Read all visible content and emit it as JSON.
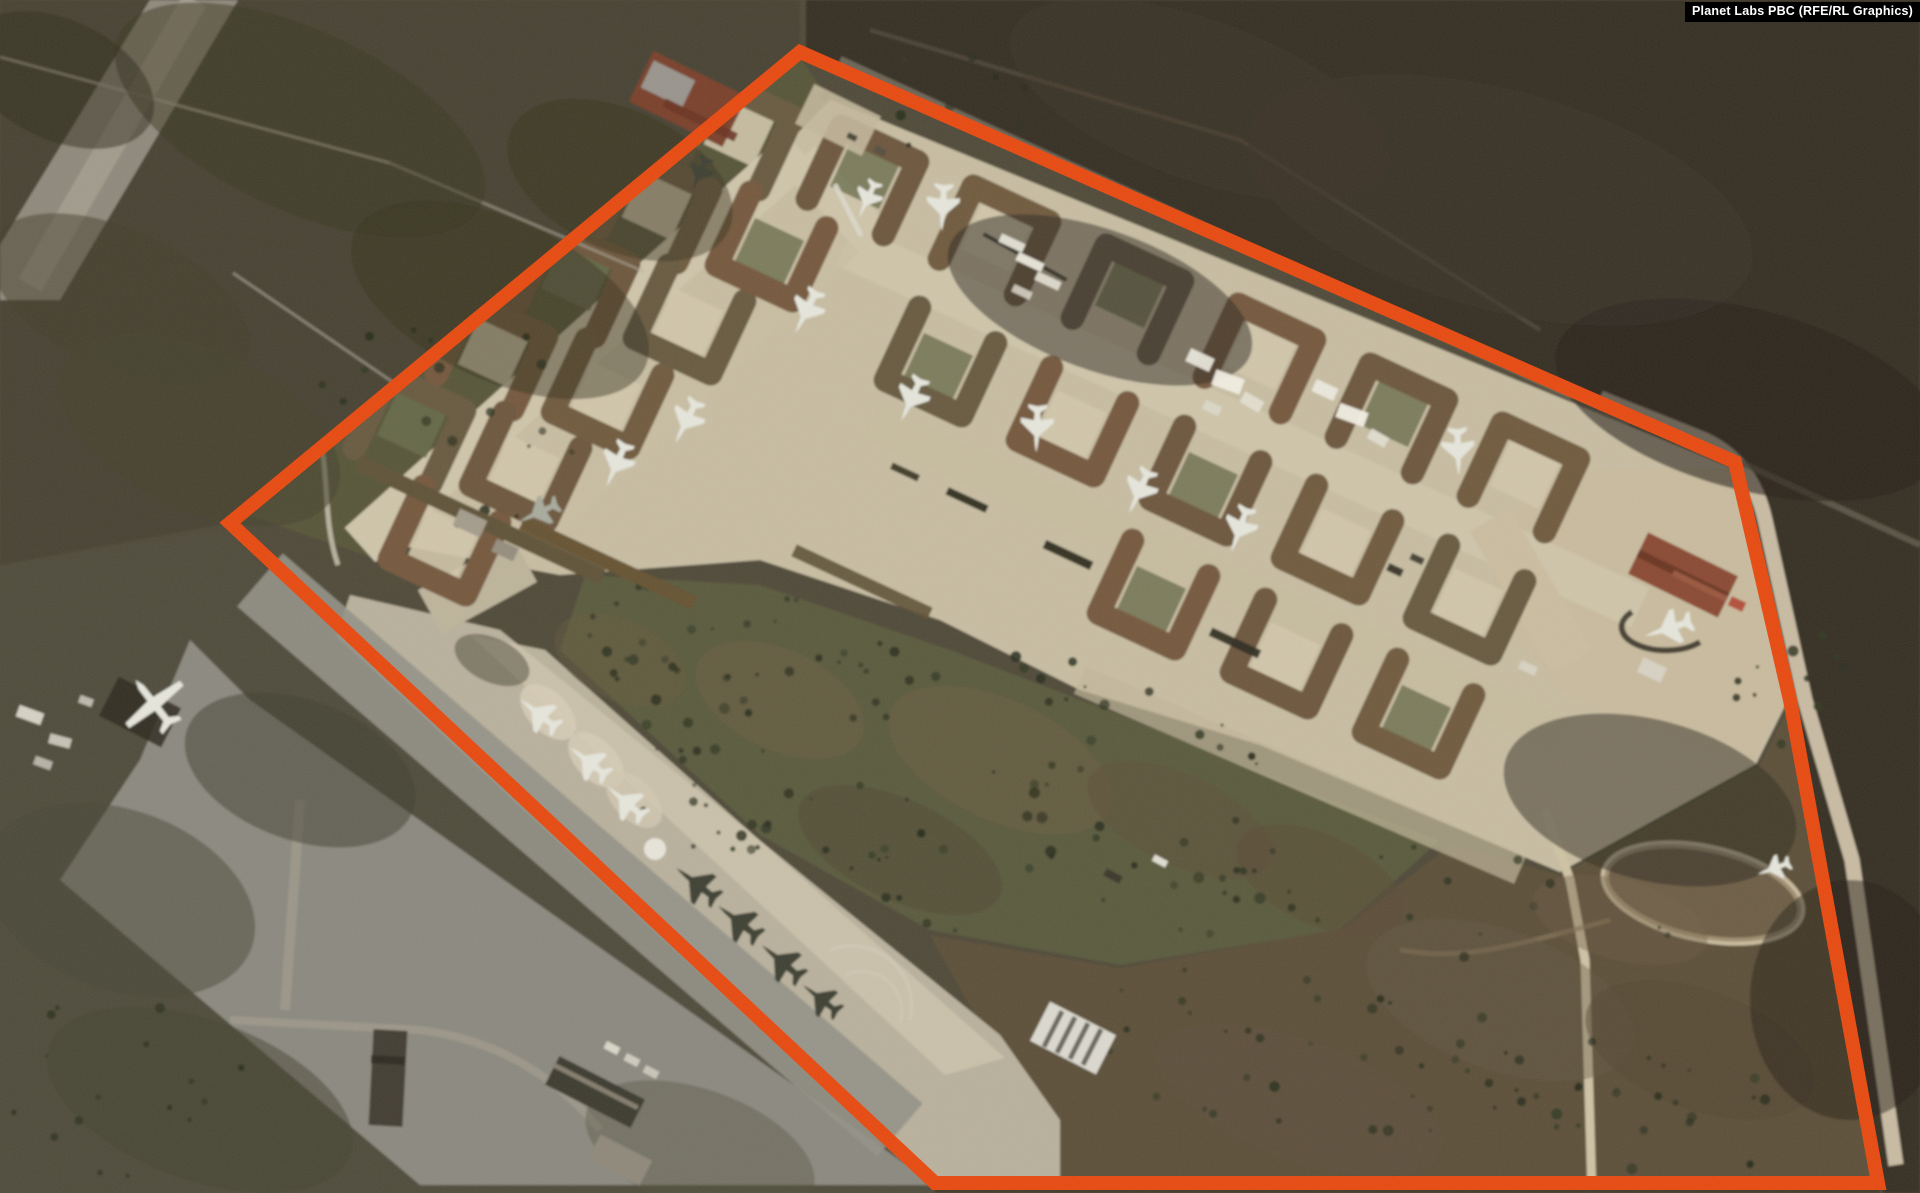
{
  "watermark": {
    "text": "Planet Labs PBC (RFE/RL Graphics)",
    "bg": "#000000",
    "color": "#ffffff"
  },
  "annotation": {
    "label": "highlighted-airbase-area",
    "color": "#E8490F",
    "stroke_width": 14,
    "points": "800,52 1735,462 1790,700 1878,1183 935,1183 230,523"
  },
  "scene": {
    "palette": {
      "field_dark": "#352e24",
      "field_olive": "#4f4a38",
      "grass": "#5a5a3d",
      "apron": "#b9b19c",
      "revetment_pad_tan": "#d2c7ab",
      "revetment_pad_green": "#696b4b",
      "berm": "#6d563c",
      "pavement": "#8b897f",
      "tree": "#2b301f",
      "jet_light": "#e6e6dc",
      "jet_dark": "#3d4033"
    },
    "aircraft": [
      {
        "k": "jet",
        "x": 943,
        "y": 206,
        "r": 183,
        "s": 1.1,
        "t": "light"
      },
      {
        "k": "jet",
        "x": 868,
        "y": 198,
        "r": 205,
        "s": 0.9,
        "t": "light"
      },
      {
        "k": "jet",
        "x": 807,
        "y": 310,
        "r": 207,
        "s": 1.1,
        "t": "light"
      },
      {
        "k": "jet",
        "x": 687,
        "y": 420,
        "r": 207,
        "s": 1.1,
        "t": "light"
      },
      {
        "k": "jet",
        "x": 617,
        "y": 463,
        "r": 204,
        "s": 1.1,
        "t": "light"
      },
      {
        "k": "jet",
        "x": 700,
        "y": 173,
        "r": 205,
        "s": 0.85,
        "t": "dark"
      },
      {
        "k": "jet",
        "x": 540,
        "y": 512,
        "r": 245,
        "s": 1.0,
        "t": "mid"
      },
      {
        "k": "jet",
        "x": 912,
        "y": 398,
        "r": 205,
        "s": 1.1,
        "t": "light"
      },
      {
        "k": "jet",
        "x": 1037,
        "y": 427,
        "r": 182,
        "s": 1.1,
        "t": "light"
      },
      {
        "k": "jet",
        "x": 1140,
        "y": 490,
        "r": 205,
        "s": 1.1,
        "t": "light"
      },
      {
        "k": "jet",
        "x": 1240,
        "y": 528,
        "r": 200,
        "s": 1.1,
        "t": "light"
      },
      {
        "k": "jet",
        "x": 1458,
        "y": 450,
        "r": 178,
        "s": 1.1,
        "t": "light"
      },
      {
        "k": "jet",
        "x": 1670,
        "y": 628,
        "r": 252,
        "s": 1.15,
        "t": "light"
      },
      {
        "k": "jet",
        "x": 1775,
        "y": 868,
        "r": 250,
        "s": 0.8,
        "t": "light"
      },
      {
        "k": "jet",
        "x": 540,
        "y": 715,
        "r": -52,
        "s": 1.1,
        "t": "light"
      },
      {
        "k": "jet",
        "x": 590,
        "y": 763,
        "r": -52,
        "s": 1.1,
        "t": "light"
      },
      {
        "k": "jet",
        "x": 627,
        "y": 803,
        "r": -50,
        "s": 1.1,
        "t": "light"
      },
      {
        "k": "jet",
        "x": 698,
        "y": 885,
        "r": -52,
        "s": 1.2,
        "t": "dark"
      },
      {
        "k": "jet",
        "x": 740,
        "y": 923,
        "r": -52,
        "s": 1.2,
        "t": "dark"
      },
      {
        "k": "jet",
        "x": 783,
        "y": 963,
        "r": -50,
        "s": 1.2,
        "t": "dark"
      },
      {
        "k": "jet",
        "x": 822,
        "y": 1000,
        "r": -52,
        "s": 1.05,
        "t": "dark"
      },
      {
        "k": "prop",
        "x": 155,
        "y": 705,
        "r": -38,
        "s": 1.5,
        "t": "light"
      }
    ],
    "revetments": [
      [
        865,
        175,
        25
      ],
      [
        997,
        235,
        25
      ],
      [
        1130,
        294,
        25
      ],
      [
        1262,
        353,
        25
      ],
      [
        1394,
        413,
        25
      ],
      [
        1526,
        472,
        25
      ],
      [
        938,
        367,
        205
      ],
      [
        1070,
        427,
        205
      ],
      [
        1203,
        486,
        205
      ],
      [
        1335,
        545,
        205
      ],
      [
        1467,
        605,
        205
      ],
      [
        1151,
        600,
        205
      ],
      [
        1284,
        659,
        205
      ],
      [
        1416,
        719,
        205
      ],
      [
        412,
        424,
        25
      ],
      [
        494,
        350,
        25
      ],
      [
        576,
        277,
        25
      ],
      [
        658,
        203,
        25
      ],
      [
        740,
        130,
        25
      ],
      [
        442,
        546,
        205
      ],
      [
        523,
        472,
        205
      ],
      [
        605,
        399,
        205
      ],
      [
        687,
        325,
        205
      ],
      [
        769,
        252,
        205
      ]
    ],
    "pads_green": [
      [
        865,
        175
      ],
      [
        1130,
        294
      ],
      [
        1394,
        413
      ],
      [
        938,
        367
      ],
      [
        1203,
        486
      ],
      [
        412,
        424
      ],
      [
        576,
        277
      ],
      [
        769,
        252
      ],
      [
        1151,
        600
      ],
      [
        1416,
        719
      ]
    ],
    "pads_tan": [
      [
        997,
        235
      ],
      [
        1262,
        353
      ],
      [
        1526,
        472
      ],
      [
        1070,
        427
      ],
      [
        1335,
        545
      ],
      [
        523,
        472
      ],
      [
        687,
        325
      ],
      [
        1284,
        659
      ],
      [
        494,
        350
      ],
      [
        658,
        203
      ],
      [
        740,
        130
      ],
      [
        605,
        399
      ],
      [
        442,
        546
      ],
      [
        1467,
        605
      ]
    ],
    "buildings": [
      [
        688,
        99,
        104,
        56,
        26,
        "#7a3f2c",
        1
      ],
      [
        668,
        84,
        46,
        30,
        26,
        "#99948c",
        1
      ],
      [
        700,
        120,
        80,
        9,
        26,
        "#6a3424",
        0.9
      ],
      [
        1683,
        575,
        100,
        46,
        26,
        "#8a4a33",
        1
      ],
      [
        1683,
        575,
        100,
        8,
        26,
        "#67331f",
        0.9
      ],
      [
        1700,
        586,
        60,
        6,
        26,
        "#9e5a41",
        0.9
      ],
      [
        1073,
        1038,
        74,
        44,
        27,
        "#dcd9cf",
        1
      ],
      [
        1053,
        1029,
        5,
        40,
        27,
        "#6b675c",
        1
      ],
      [
        1066,
        1035,
        5,
        40,
        27,
        "#6b675c",
        1
      ],
      [
        1079,
        1041,
        5,
        40,
        27,
        "#6b675c",
        1
      ],
      [
        1092,
        1047,
        5,
        40,
        27,
        "#6b675c",
        1
      ],
      [
        388,
        1078,
        34,
        96,
        3,
        "#423c30",
        1
      ],
      [
        388,
        1060,
        34,
        8,
        3,
        "#2e2a20",
        1
      ],
      [
        595,
        1092,
        96,
        32,
        27,
        "#3e3a2f",
        1
      ],
      [
        595,
        1086,
        96,
        5,
        27,
        "#8b8574",
        0.9
      ],
      [
        620,
        1160,
        58,
        28,
        27,
        "#8f887a",
        1
      ],
      [
        470,
        523,
        30,
        18,
        25,
        "#a49c8c",
        1
      ],
      [
        505,
        550,
        24,
        14,
        25,
        "#958d7e",
        1
      ],
      [
        1652,
        670,
        26,
        16,
        25,
        "#d8d2c4",
        1
      ]
    ],
    "objects": [
      [
        480,
        520,
        270,
        16,
        25,
        "#5f5238",
        1
      ],
      [
        608,
        563,
        190,
        14,
        25,
        "#665232",
        1
      ],
      [
        862,
        582,
        150,
        13,
        25,
        "#5c5036",
        0.9
      ],
      [
        838,
        120,
        74,
        44,
        26,
        "#c3b89c",
        0.9
      ],
      [
        852,
        137,
        10,
        6,
        26,
        "#4a4637",
        1
      ],
      [
        880,
        151,
        12,
        7,
        26,
        "#55503f",
        1
      ],
      [
        848,
        210,
        58,
        5,
        63,
        "#dcd8ca",
        0.9
      ],
      [
        1025,
        257,
        95,
        4,
        29,
        "#2e2b20",
        0.9
      ],
      [
        1012,
        243,
        26,
        9,
        25,
        "#e6e3d6",
        0.95
      ],
      [
        1030,
        262,
        28,
        9,
        25,
        "#efece0",
        0.95
      ],
      [
        1048,
        281,
        26,
        9,
        25,
        "#e6e3d6",
        0.9
      ],
      [
        1022,
        292,
        20,
        8,
        25,
        "#dedbcd",
        0.85
      ],
      [
        1200,
        360,
        26,
        14,
        25,
        "#e9e6da",
        0.95
      ],
      [
        1228,
        382,
        30,
        16,
        20,
        "#f2efe4",
        0.95
      ],
      [
        1252,
        402,
        22,
        12,
        30,
        "#e4e1d3",
        0.9
      ],
      [
        1212,
        408,
        18,
        10,
        25,
        "#dcd9cb",
        0.85
      ],
      [
        1325,
        390,
        24,
        13,
        25,
        "#eceadf",
        0.95
      ],
      [
        1352,
        415,
        30,
        15,
        20,
        "#f4f1e6",
        0.95
      ],
      [
        1378,
        438,
        20,
        11,
        30,
        "#e2dfd2",
        0.9
      ],
      [
        1395,
        570,
        16,
        8,
        25,
        "#3c382c",
        1
      ],
      [
        1417,
        559,
        14,
        7,
        25,
        "#474334",
        1
      ],
      [
        1113,
        876,
        18,
        8,
        28,
        "#3a372b",
        1
      ],
      [
        1160,
        861,
        15,
        7,
        28,
        "#e8e5d8",
        0.95
      ],
      [
        30,
        715,
        26,
        12,
        20,
        "#dcd9cc",
        0.95
      ],
      [
        60,
        741,
        22,
        10,
        15,
        "#d3d0c3",
        0.9
      ],
      [
        43,
        763,
        18,
        9,
        20,
        "#c8c5b8",
        0.85
      ],
      [
        86,
        701,
        14,
        8,
        20,
        "#d0cdc0",
        0.85
      ],
      [
        612,
        1048,
        15,
        8,
        27,
        "#dddacd",
        0.95
      ],
      [
        632,
        1060,
        15,
        8,
        27,
        "#d6d3c6",
        0.9
      ],
      [
        651,
        1072,
        15,
        8,
        27,
        "#cfccbf",
        0.9
      ],
      [
        1528,
        668,
        18,
        9,
        25,
        "#d9d4c4",
        0.9
      ],
      [
        1737,
        604,
        16,
        10,
        25,
        "#b24a35",
        0.95
      ],
      [
        967,
        500,
        44,
        8,
        25,
        "#2c2a1e",
        0.95
      ],
      [
        1068,
        555,
        52,
        9,
        25,
        "#2c2a1e",
        0.95
      ],
      [
        1235,
        643,
        54,
        9,
        25,
        "#302d20",
        0.95
      ],
      [
        905,
        472,
        30,
        7,
        25,
        "#33301f",
        0.9
      ],
      [
        140,
        712,
        70,
        44,
        27,
        "#2e2a20",
        0.85
      ]
    ],
    "ellipses": [
      [
        548,
        712,
        34,
        20,
        45,
        "#d6ccb6",
        0.9
      ],
      [
        596,
        760,
        34,
        20,
        45,
        "#d6ccb6",
        0.85
      ],
      [
        634,
        800,
        34,
        20,
        45,
        "#d2c8b2",
        0.8
      ],
      [
        492,
        660,
        40,
        22,
        25,
        "#4a4534",
        0.5
      ],
      [
        655,
        849,
        11,
        11,
        0,
        "#e9e7dd",
        0.95
      ],
      [
        1000,
        760,
        120,
        60,
        25,
        "#6d5c41",
        0.5
      ],
      [
        780,
        700,
        90,
        50,
        25,
        "#705e42",
        0.45
      ],
      [
        1180,
        820,
        100,
        45,
        25,
        "#5e4f38",
        0.5
      ],
      [
        620,
        660,
        70,
        40,
        25,
        "#6a5a40",
        0.4
      ],
      [
        900,
        850,
        110,
        50,
        25,
        "#4e4730",
        0.45
      ],
      [
        1320,
        880,
        90,
        45,
        25,
        "#5a4c36",
        0.5
      ],
      [
        1500,
        1000,
        140,
        70,
        20,
        "#655740",
        0.4
      ],
      [
        1700,
        1050,
        120,
        60,
        20,
        "#554834",
        0.5
      ],
      [
        1300,
        1100,
        150,
        60,
        20,
        "#60523c",
        0.4
      ],
      [
        1620,
        920,
        90,
        40,
        15,
        "#6b5b42",
        0.4
      ],
      [
        1703,
        893,
        100,
        45,
        12,
        "#7b6a4f",
        0.55
      ],
      [
        1500,
        200,
        260,
        110,
        15,
        "#3a332a",
        0.5
      ],
      [
        1750,
        400,
        200,
        90,
        15,
        "#2b251d",
        0.6
      ],
      [
        1200,
        100,
        200,
        80,
        20,
        "#403828",
        0.4
      ],
      [
        1650,
        800,
        150,
        80,
        15,
        "#2e2920",
        0.5
      ],
      [
        1100,
        300,
        160,
        70,
        20,
        "#2e281f",
        0.5
      ],
      [
        1850,
        1000,
        100,
        120,
        0,
        "#282218",
        0.5
      ],
      [
        300,
        120,
        200,
        90,
        25,
        "#3b3522",
        0.5
      ],
      [
        120,
        300,
        140,
        70,
        25,
        "#433d2a",
        0.5
      ],
      [
        500,
        300,
        160,
        80,
        25,
        "#35301d",
        0.45
      ],
      [
        60,
        80,
        100,
        60,
        25,
        "#2f2b1b",
        0.5
      ],
      [
        200,
        430,
        150,
        80,
        25,
        "#46452e",
        0.6
      ],
      [
        620,
        180,
        120,
        70,
        25,
        "#3a3420",
        0.45
      ],
      [
        120,
        900,
        140,
        90,
        20,
        "#4a4836",
        0.5
      ],
      [
        300,
        770,
        120,
        70,
        20,
        "#3f3d2d",
        0.5
      ],
      [
        200,
        1100,
        160,
        80,
        20,
        "#454231",
        0.5
      ],
      [
        700,
        1150,
        120,
        60,
        20,
        "#52503f",
        0.4
      ]
    ],
    "tree_clusters": [
      [
        950,
        790,
        340,
        150,
        85,
        7
      ],
      [
        1400,
        1010,
        300,
        170,
        55,
        11
      ],
      [
        1810,
        690,
        80,
        60,
        12,
        3
      ],
      [
        950,
        100,
        140,
        50,
        11,
        5
      ],
      [
        470,
        420,
        160,
        110,
        22,
        9
      ],
      [
        140,
        1080,
        170,
        100,
        16,
        13
      ],
      [
        1240,
        900,
        90,
        55,
        10,
        17
      ],
      [
        700,
        640,
        120,
        70,
        25,
        21
      ],
      [
        1600,
        1120,
        200,
        70,
        22,
        23
      ]
    ]
  }
}
